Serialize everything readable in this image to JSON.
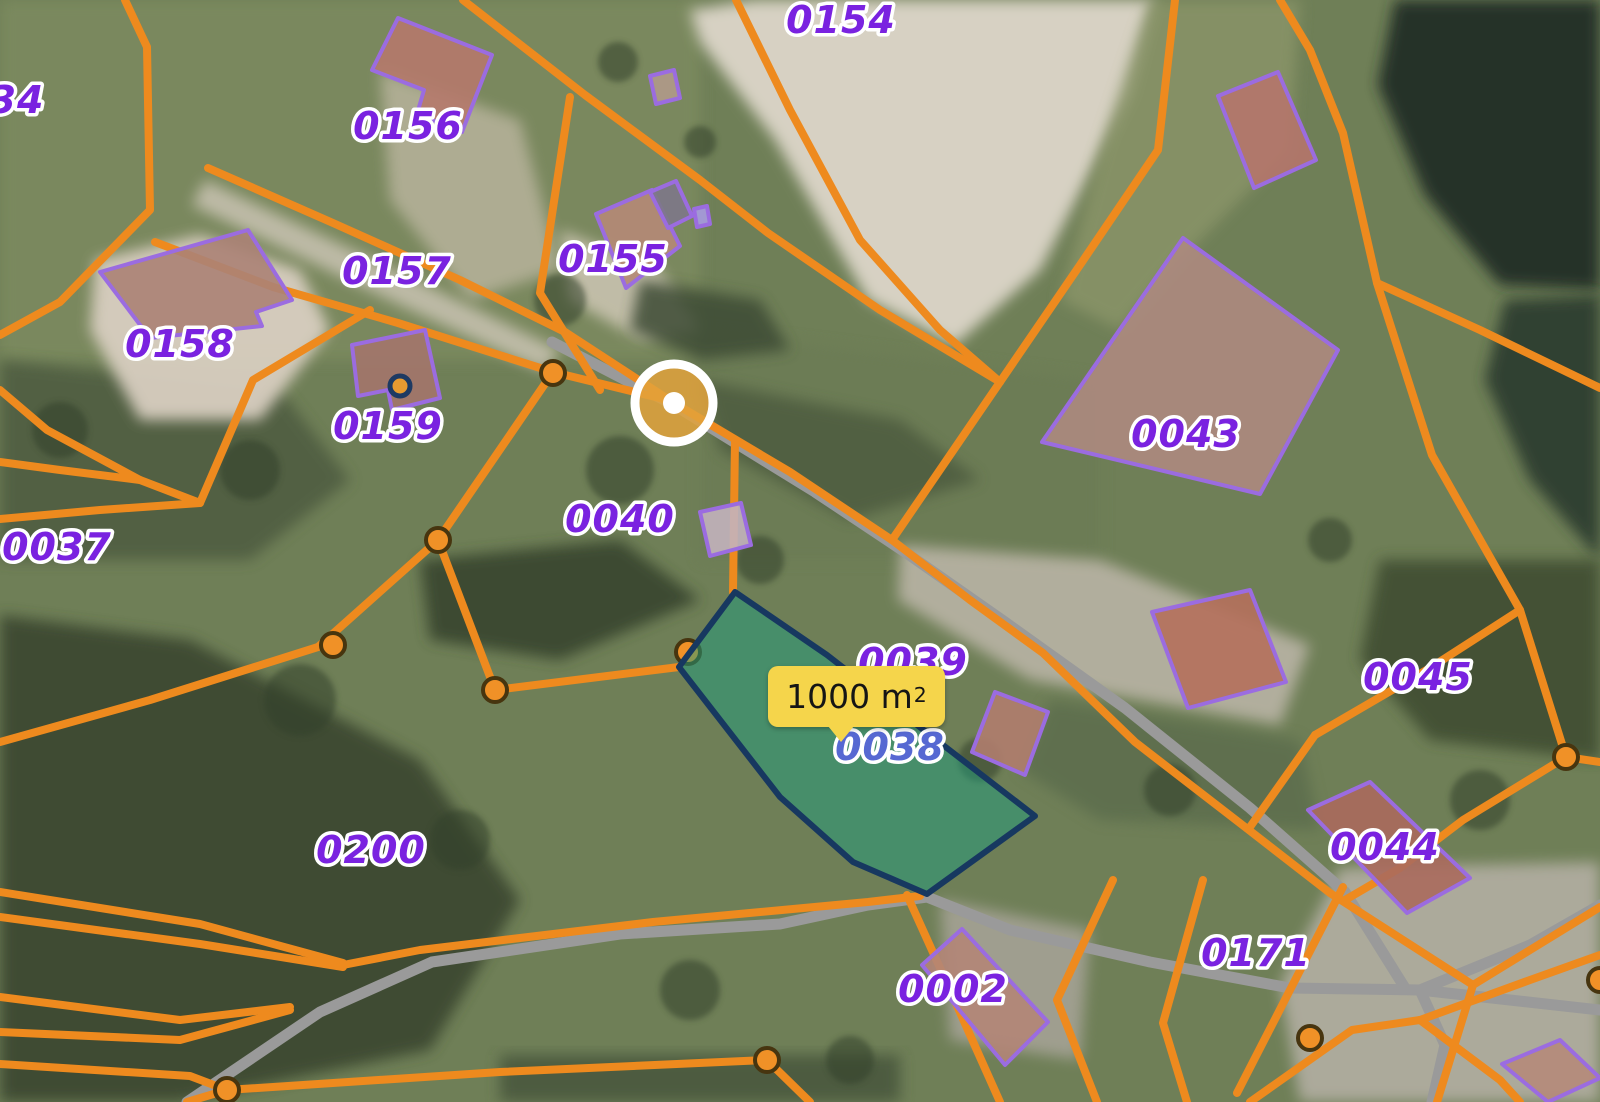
{
  "map": {
    "title": "Cadastral parcel map",
    "parcel_labels": [
      {
        "id": "0154",
        "text": "0154",
        "x": 841,
        "y": 20
      },
      {
        "id": "0156",
        "text": "0156",
        "x": 408,
        "y": 126
      },
      {
        "id": "0157",
        "text": "0157",
        "x": 397,
        "y": 271
      },
      {
        "id": "0158",
        "text": "0158",
        "x": 180,
        "y": 344
      },
      {
        "id": "0159",
        "text": "0159",
        "x": 388,
        "y": 426
      },
      {
        "id": "0155",
        "text": "0155",
        "x": 613,
        "y": 259
      },
      {
        "id": "0040",
        "text": "0040",
        "x": 620,
        "y": 519
      },
      {
        "id": "0037",
        "text": "0037",
        "x": 57,
        "y": 547
      },
      {
        "id": "0043",
        "text": "0043",
        "x": 1186,
        "y": 434
      },
      {
        "id": "0039",
        "text": "0039",
        "x": 913,
        "y": 662
      },
      {
        "id": "0038",
        "text": "0038",
        "x": 890,
        "y": 747,
        "color": "#5668d2"
      },
      {
        "id": "0045",
        "text": "0045",
        "x": 1418,
        "y": 677
      },
      {
        "id": "0044",
        "text": "0044",
        "x": 1385,
        "y": 847
      },
      {
        "id": "0200",
        "text": "0200",
        "x": 371,
        "y": 850
      },
      {
        "id": "0171",
        "text": "0171",
        "x": 1256,
        "y": 953
      },
      {
        "id": "0002",
        "text": "0002",
        "x": 953,
        "y": 989
      },
      {
        "id": "0034",
        "text": "34",
        "x": 17,
        "y": 100
      }
    ],
    "area_tooltip": {
      "text": "1000 m",
      "sup": "2"
    },
    "selected_marker": {
      "x": 674,
      "y": 403
    },
    "highlighted_parcel": "0038",
    "colors": {
      "boundary_orange": "#ee8a1e",
      "label_purple": "#7a22e0",
      "label_highlight_blue": "#5668d2",
      "highlight_fill": "#1f9e7e",
      "highlight_stroke": "#173860",
      "tooltip_bg": "#f5d54b",
      "road_gray": "#9a9a9a",
      "building_stroke": "#9b6ce0",
      "vertex_fill": "#f09127",
      "vertex_ring": "#47350f",
      "marker_disc": "#e2a23c"
    }
  }
}
